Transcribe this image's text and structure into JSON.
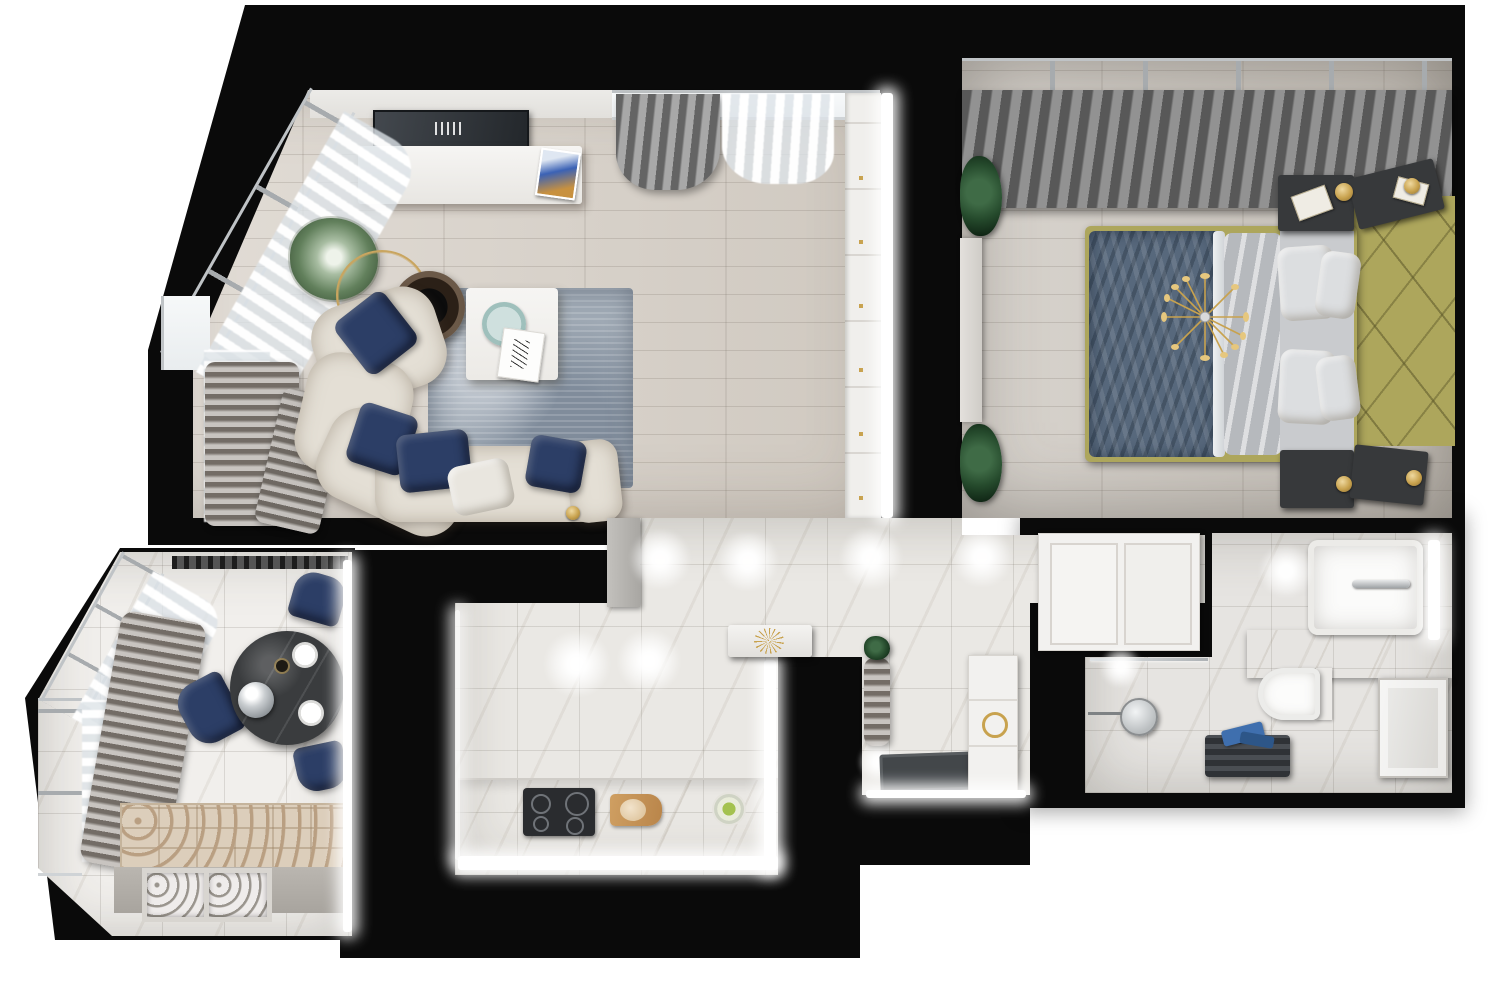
{
  "scene": {
    "title": "3D apartment floor plan — photorealistic top-down render",
    "background": "#ffffff",
    "wall_color": "#0a0a0a"
  },
  "palette": {
    "navy": "#2c3e66",
    "sofa_cream": "#e4dfd5",
    "wood_living": "#d8d1c8",
    "wood_bedroom": "#ccc6be",
    "marble": "#eae8e4",
    "marble_bright": "#f1efec",
    "rug": "#9fa9b4",
    "curtain_gray": "#8a8a8a",
    "olive": "#ada65c",
    "quilt_blue": "#57687c",
    "duvet_gray": "#b6b9bd",
    "pillow_white": "#dcdee0",
    "gold": "#c8a24e",
    "black_marble_table": "#3a3c3e",
    "doormat": "#43474a",
    "bench_taupe": "#9b948d",
    "cooktop_dark": "#2a2c2f",
    "towel_blue": "#3f6fae",
    "plant_green": "#2e4f33"
  },
  "rooms": [
    {
      "id": "living-room",
      "name": "Living room",
      "items": [
        "corner window bay with sheer curtains",
        "gray curtains",
        "wall TV panel",
        "white media console",
        "magazine",
        "potted plant",
        "gold wire basket",
        "round dark side table",
        "white coffee table",
        "teal decor tray",
        "fashion art card",
        "blue-gray area rug",
        "curved cream sectional sofa",
        "navy velvet pillows (4)",
        "white pillow",
        "gray ribbed throw",
        "built-in wardrobe with LED strip"
      ]
    },
    {
      "id": "bedroom",
      "name": "Bedroom",
      "items": [
        "window wall with gray and sheer curtains",
        "double bed",
        "navy quilted bedspread",
        "gray duvet",
        "white pillows (4)",
        "olive upholstered headboard wall",
        "gold sputnik chandelier",
        "dark nightstands (4)",
        "books (2)",
        "gold sconce lamps (4)",
        "plants (2)",
        "white dresser"
      ]
    },
    {
      "id": "kitchen",
      "name": "Kitchen",
      "items": [
        "ceiling spotlights",
        "tall gray cabinet",
        "marble worktop",
        "induction cooktop",
        "cutting board with bread",
        "fruit bowl",
        "LED under-cabinet strips"
      ]
    },
    {
      "id": "corridor",
      "name": "Corridor",
      "items": [
        "ceiling spotlights",
        "white console table",
        "gold sunburst decor"
      ]
    },
    {
      "id": "hallway",
      "name": "Entrance hall",
      "items": [
        "upholstered bench",
        "plant",
        "glowing floor lamp",
        "dark doormat",
        "white wardrobe with gold knob",
        "LED strip at door"
      ]
    },
    {
      "id": "storage",
      "name": "Built-in closet",
      "items": [
        "white paneled closet doors"
      ]
    },
    {
      "id": "bathroom",
      "name": "Bathroom",
      "items": [
        "washbasin with chrome faucet",
        "marble vanity counter",
        "LED backlight",
        "wall-hung toilet",
        "white paneled door leaf",
        "dark towel bench with blue towels",
        "round cosmetic mirror",
        "glass shower partition"
      ]
    },
    {
      "id": "dining-balcony",
      "name": "Dining loggia",
      "items": [
        "panoramic angled windows",
        "sheer curtains",
        "taupe curtain",
        "curtain rail",
        "round black marble dining table",
        "white plates (2)",
        "silver cloche",
        "navy dining chairs (3)",
        "ornamental tile runner",
        "decorative radiator grilles (2)",
        "LED strip"
      ]
    }
  ]
}
